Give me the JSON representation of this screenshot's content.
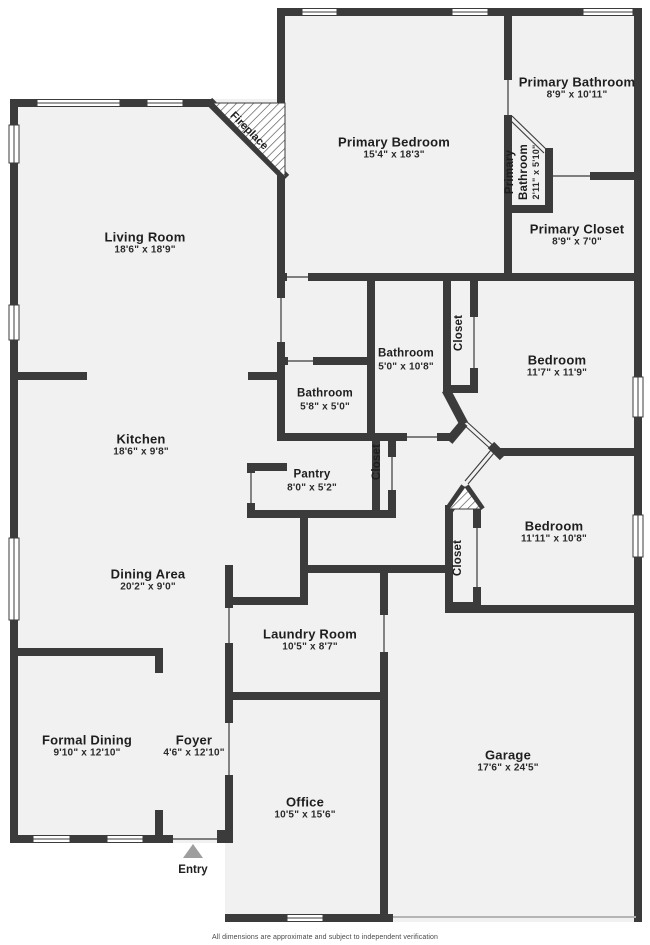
{
  "title": "Floor plan",
  "colors": {
    "wall": "#3b3b3b",
    "floor": "#f1f1f1",
    "outside": "#ffffff",
    "entry_arrow": "#9e9e9e",
    "text": "#1e1e1e"
  },
  "rooms": [
    {
      "name": "Primary Bathroom",
      "dims": "8'9\" x 10'11\"",
      "x": 577,
      "y": 88
    },
    {
      "name": "Primary Bedroom",
      "dims": "15'4\" x 18'3\"",
      "x": 394,
      "y": 148
    },
    {
      "name": "Primary Bathroom",
      "dims": "2'11\" x 5'10\"",
      "x": 523,
      "y": 172,
      "rot": true,
      "wrap": true
    },
    {
      "name": "Primary Closet",
      "dims": "8'9\" x 7'0\"",
      "x": 577,
      "y": 235
    },
    {
      "name": "Living Room",
      "dims": "18'6\" x 18'9\"",
      "x": 145,
      "y": 243
    },
    {
      "name": "Bathroom",
      "dims": "5'0\" x 10'8\"",
      "x": 406,
      "y": 360,
      "small": true
    },
    {
      "name": "Closet",
      "dims": "",
      "x": 460,
      "y": 333,
      "rot": true
    },
    {
      "name": "Bedroom",
      "dims": "11'7\" x 11'9\"",
      "x": 557,
      "y": 366
    },
    {
      "name": "Bathroom",
      "dims": "5'8\" x 5'0\"",
      "x": 325,
      "y": 400,
      "small": true
    },
    {
      "name": "Kitchen",
      "dims": "18'6\" x 9'8\"",
      "x": 141,
      "y": 445
    },
    {
      "name": "Pantry",
      "dims": "8'0\" x 5'2\"",
      "x": 312,
      "y": 481,
      "small": true
    },
    {
      "name": "Closet",
      "dims": "",
      "x": 378,
      "y": 462,
      "rot": true
    },
    {
      "name": "Bedroom",
      "dims": "11'11\" x 10'8\"",
      "x": 554,
      "y": 532
    },
    {
      "name": "Closet",
      "dims": "",
      "x": 459,
      "y": 558,
      "rot": true
    },
    {
      "name": "Dining Area",
      "dims": "20'2\" x 9'0\"",
      "x": 148,
      "y": 580
    },
    {
      "name": "Laundry Room",
      "dims": "10'5\" x 8'7\"",
      "x": 310,
      "y": 640
    },
    {
      "name": "Formal Dining",
      "dims": "9'10\" x 12'10\"",
      "x": 87,
      "y": 746
    },
    {
      "name": "Foyer",
      "dims": "4'6\" x 12'10\"",
      "x": 194,
      "y": 746
    },
    {
      "name": "Garage",
      "dims": "17'6\" x 24'5\"",
      "x": 508,
      "y": 761
    },
    {
      "name": "Office",
      "dims": "10'5\" x 15'6\"",
      "x": 305,
      "y": 808
    }
  ],
  "fireplace": {
    "label": "Fireplace",
    "x": 249,
    "y": 131
  },
  "entry": {
    "label": "Entry",
    "x": 193,
    "y": 864
  },
  "footer": {
    "disclaimer": "All dimensions are approximate and subject to independent verification"
  }
}
